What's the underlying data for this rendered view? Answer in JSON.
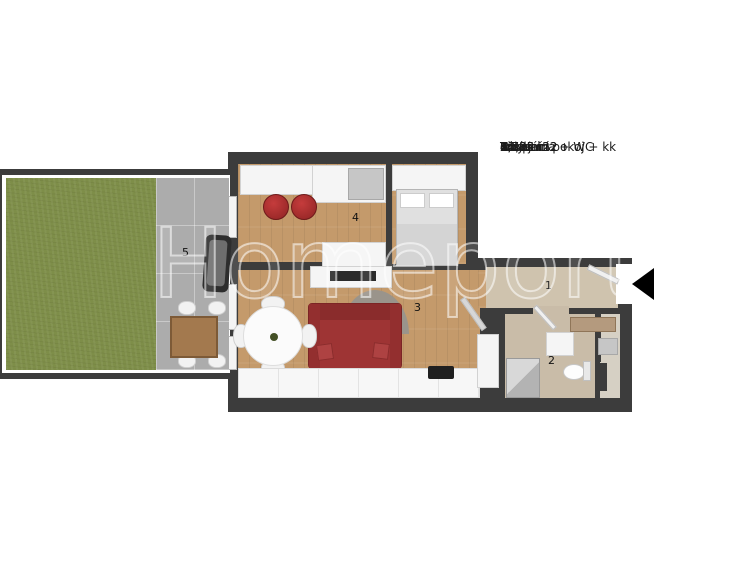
{
  "legend": {
    "items": [
      {
        "num": "1",
        "name": "Předsíň",
        "area": "3,39 m2"
      },
      {
        "num": "2",
        "name": "Koupelna + WC",
        "area": "4,73 m2"
      },
      {
        "num": "3",
        "name": "Obývací pokoj + kk",
        "area": "22,95 m2"
      },
      {
        "num": "4",
        "name": "Pokoj",
        "area": "14,22 m2"
      },
      {
        "num": "5",
        "name": "Terasa",
        "area": ""
      }
    ]
  },
  "plan": {
    "watermark": "Homeport",
    "room_labels": {
      "hallway": "1",
      "bathroom": "2",
      "living_room": "3",
      "room": "4",
      "terrace": "5"
    },
    "colors": {
      "wall": "#3c3c3c",
      "wood_floor": "#c49a6b",
      "grass": "#7e8e49",
      "concrete": "#acacac",
      "tile_floor": "#cfc3ae",
      "sofa_red": "#9e3434",
      "entry_arrow": "#000000"
    }
  }
}
